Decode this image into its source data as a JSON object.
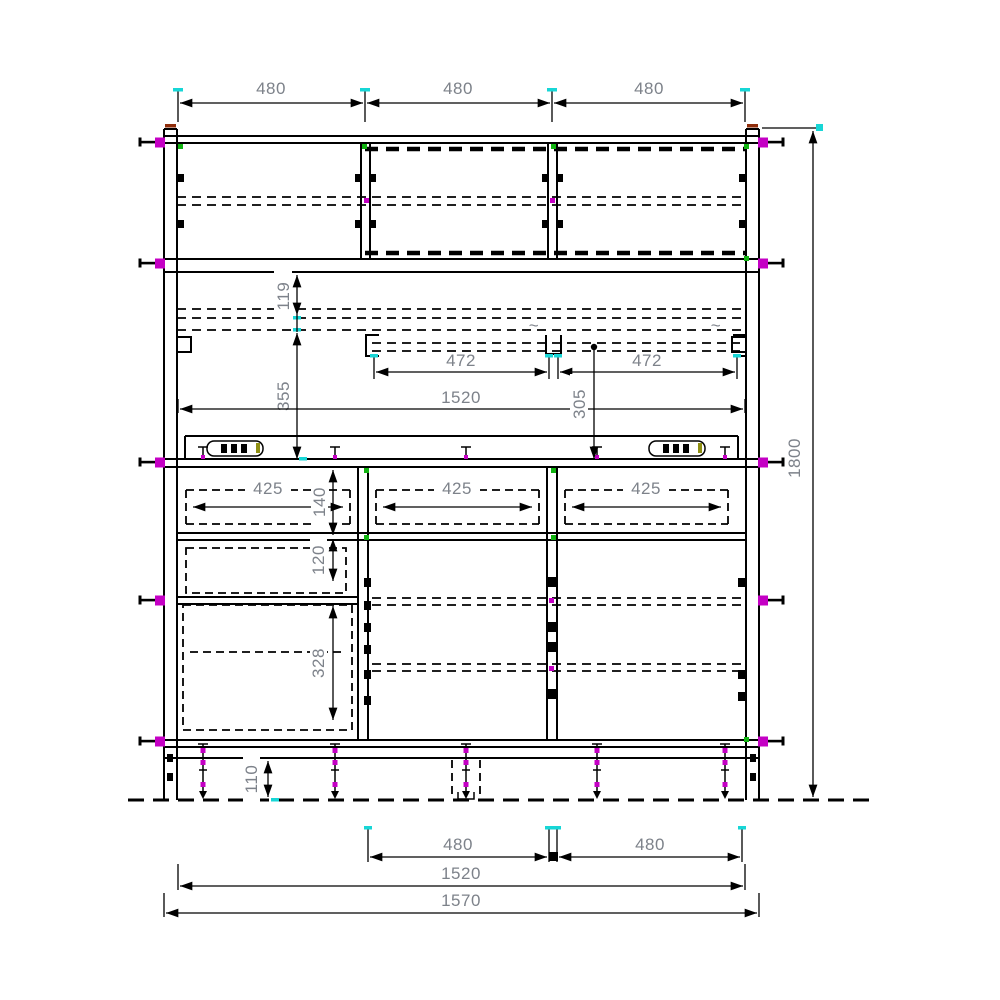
{
  "drawing": {
    "kind": "furniture-front-elevation",
    "colors": {
      "line": "#000000",
      "dim_text": "#7d828a",
      "grip_magenta": "#c400c4",
      "tick_cyan": "#17d6d6",
      "node_green": "#11b411",
      "cap_red": "#8f2c0a",
      "outlet_olive": "#8f8f12",
      "background": "#ffffff"
    },
    "dims": {
      "top_480_1": "480",
      "top_480_2": "480",
      "top_480_3": "480",
      "height_1800": "1800",
      "v119": "119",
      "v355": "355",
      "rail_472_left": "472",
      "rail_472_right": "472",
      "inner_1520": "1520",
      "v305": "305",
      "drawer_425_left": "425",
      "drawer_425_mid": "425",
      "drawer_425_right": "425",
      "v140": "140",
      "v120": "120",
      "v328": "328",
      "v110": "110",
      "bottom_480_left": "480",
      "bottom_480_right": "480",
      "bottom_1520": "1520",
      "overall_1570": "1570"
    },
    "marks": {
      "break_tilde_left": "~",
      "break_tilde_right": "~"
    }
  }
}
